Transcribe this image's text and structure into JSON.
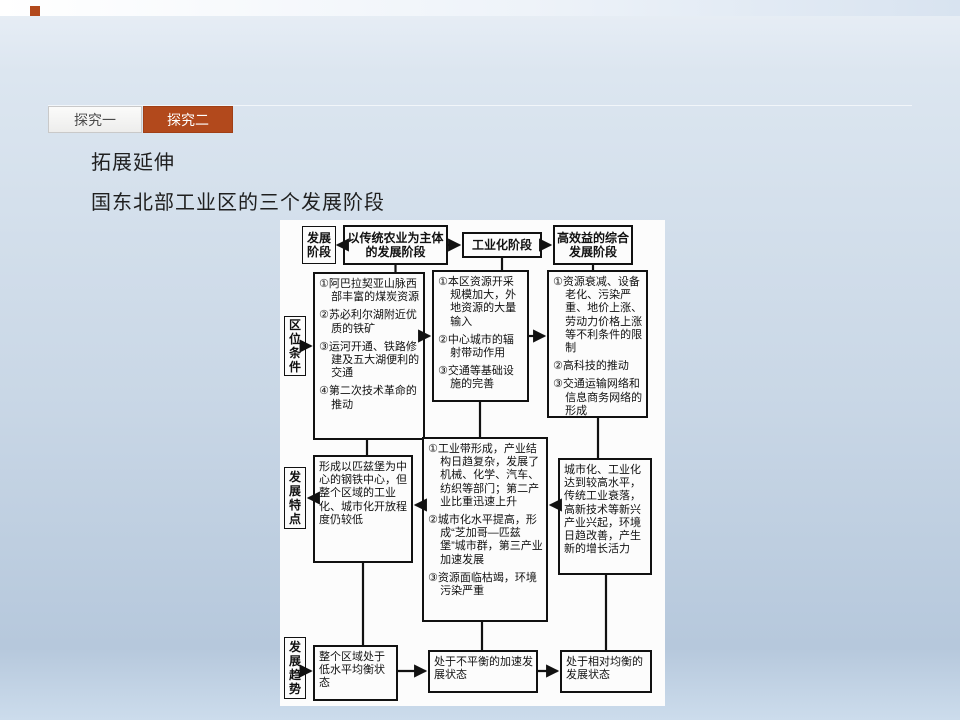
{
  "colors": {
    "accent": "#b2491c"
  },
  "tabs": [
    {
      "label": "探究一",
      "active": false
    },
    {
      "label": "探究二",
      "active": true
    }
  ],
  "heading": {
    "line1": "拓展延伸",
    "line2": "国东北部工业区的三个发展阶段"
  },
  "diagram": {
    "row1": {
      "label": "发展阶段",
      "stage1": "以传统农业为主体的发展阶段",
      "stage2": "工业化阶段",
      "stage3": "高效益的综合发展阶段"
    },
    "location": {
      "label": "区位条件",
      "col1": [
        "①阿巴拉契亚山脉西部丰富的煤炭资源",
        "②苏必利尔湖附近优质的铁矿",
        "③运河开通、铁路修建及五大湖便利的交通",
        "④第二次技术革命的推动"
      ],
      "col2": [
        "①本区资源开采规模加大，外地资源的大量输入",
        "②中心城市的辐射带动作用",
        "③交通等基础设施的完善"
      ],
      "col3": [
        "①资源衰减、设备老化、污染严重、地价上涨、劳动力价格上涨等不利条件的限制",
        "②高科技的推动",
        "③交通运输网络和信息商务网络的形成"
      ]
    },
    "features": {
      "label": "发展特点",
      "col1": "形成以匹兹堡为中心的钢铁中心，但整个区域的工业化、城市化开放程度仍较低",
      "col2": [
        "①工业带形成，产业结构日趋复杂，发展了机械、化学、汽车、纺织等部门；第二产业比重迅速上升",
        "②城市化水平提高，形成“芝加哥—匹兹堡”城市群，第三产业加速发展",
        "③资源面临枯竭，环境污染严重"
      ],
      "col3": "城市化、工业化达到较高水平，传统工业衰落，高新技术等新兴产业兴起，环境日趋改善，产生新的增长活力"
    },
    "trend": {
      "label": "发展趋势",
      "col1": "整个区域处于低水平均衡状态",
      "col2": "处于不平衡的加速发展状态",
      "col3": "处于相对均衡的发展状态"
    }
  }
}
